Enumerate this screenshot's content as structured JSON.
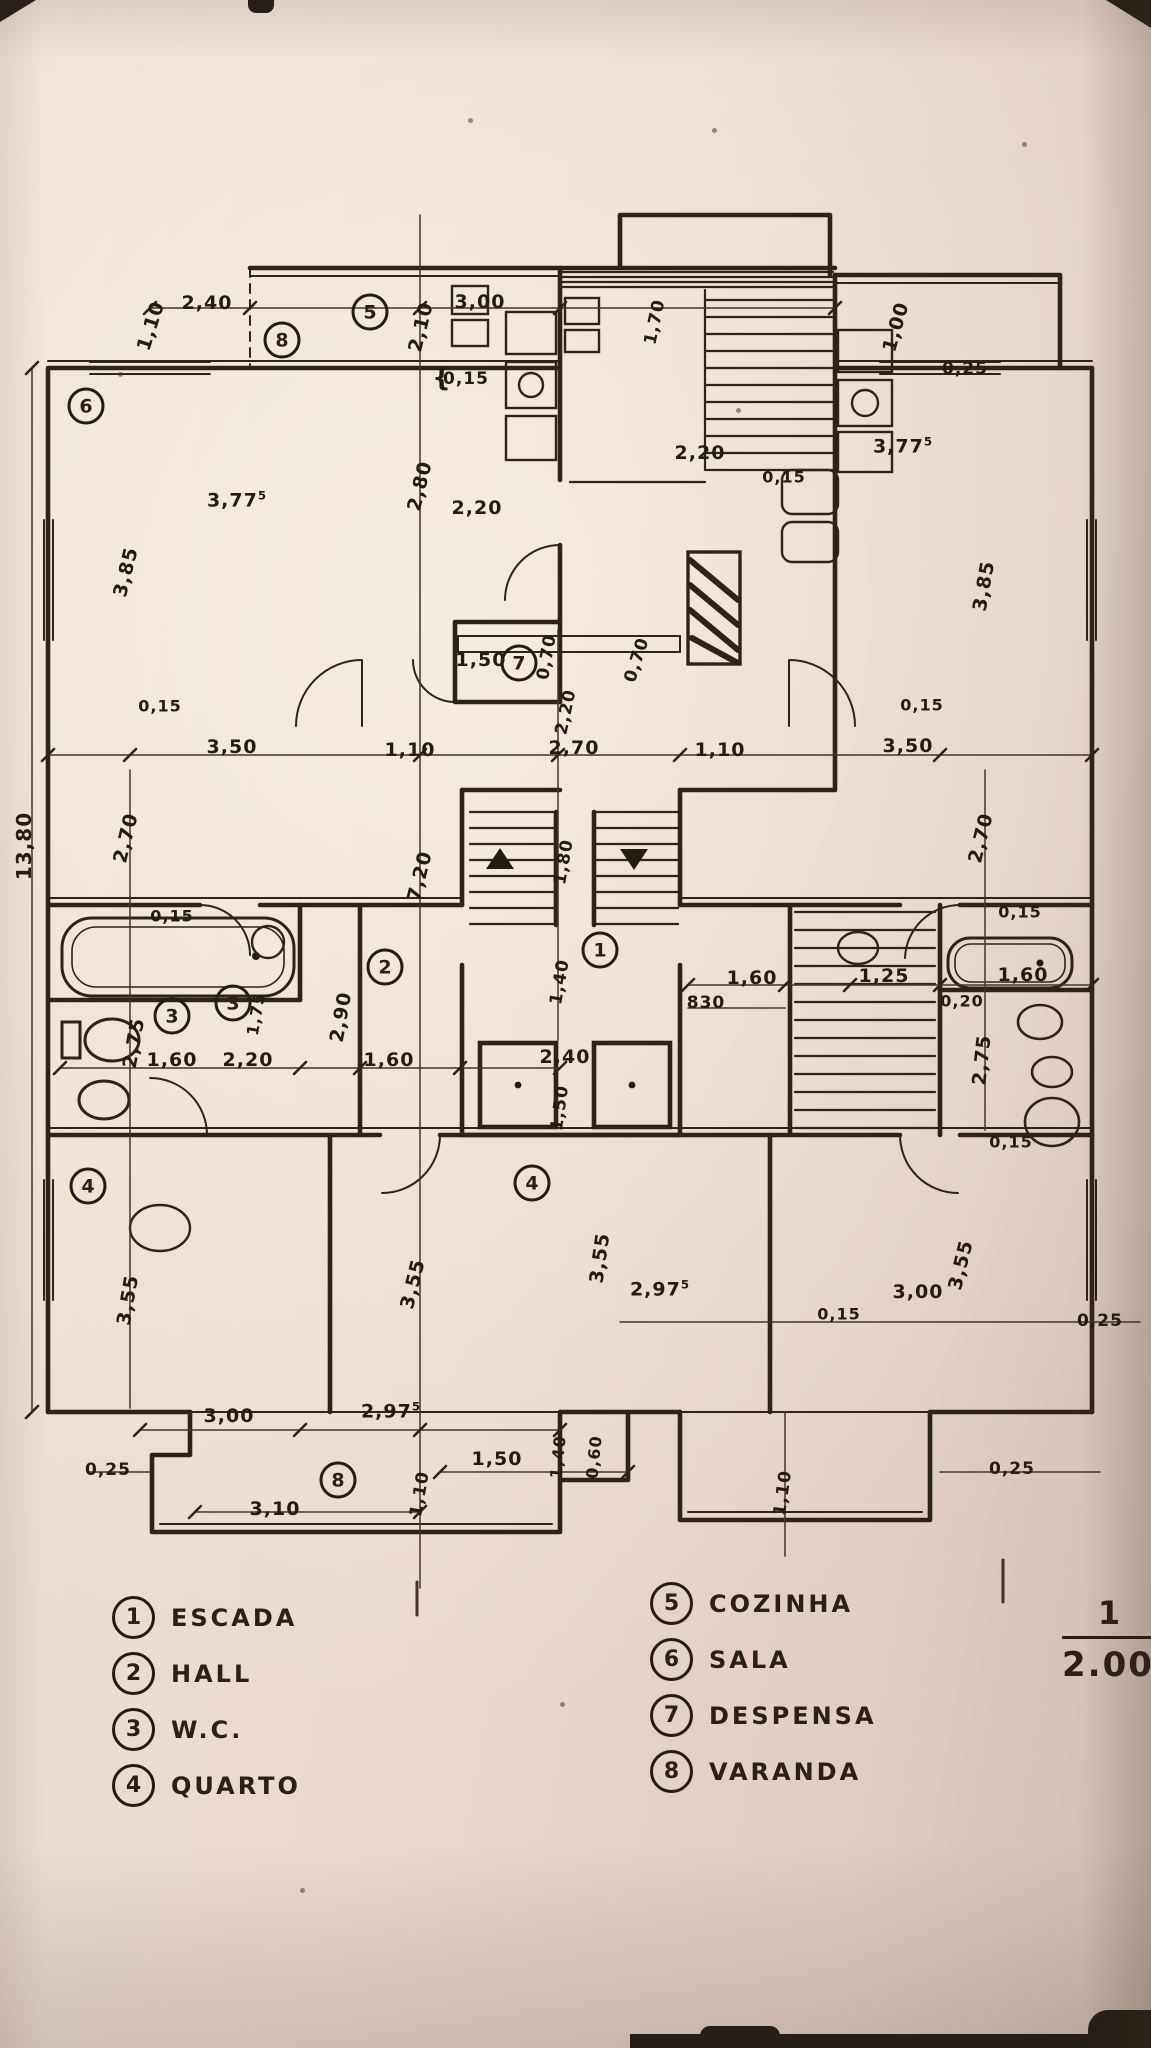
{
  "photo": {
    "paper_color": "#e8dacd",
    "ink_color": "#2a2018"
  },
  "legend_left": {
    "items": [
      {
        "num": "1",
        "label": "ESCADA"
      },
      {
        "num": "2",
        "label": "HALL"
      },
      {
        "num": "3",
        "label": "W.C."
      },
      {
        "num": "4",
        "label": "QUARTO"
      }
    ]
  },
  "legend_right": {
    "items": [
      {
        "num": "5",
        "label": "COZINHA"
      },
      {
        "num": "6",
        "label": "SALA"
      },
      {
        "num": "7",
        "label": "DESPENSA"
      },
      {
        "num": "8",
        "label": "VARANDA"
      }
    ]
  },
  "scale": {
    "numerator": "1",
    "denominator": "2.000"
  },
  "plan": {
    "room_markers": [
      {
        "num": "5",
        "x": 370,
        "y": 312
      },
      {
        "num": "8",
        "x": 282,
        "y": 340
      },
      {
        "num": "6",
        "x": 86,
        "y": 406
      },
      {
        "num": "7",
        "x": 519,
        "y": 663
      },
      {
        "num": "1",
        "x": 600,
        "y": 950
      },
      {
        "num": "2",
        "x": 385,
        "y": 967
      },
      {
        "num": "3",
        "x": 172,
        "y": 1016
      },
      {
        "num": "3",
        "x": 233,
        "y": 1003
      },
      {
        "num": "4",
        "x": 88,
        "y": 1186
      },
      {
        "num": "4",
        "x": 532,
        "y": 1183
      },
      {
        "num": "8",
        "x": 338,
        "y": 1480
      }
    ],
    "dimensions": [
      {
        "t": "1,10",
        "x": 151,
        "y": 326,
        "r": -72
      },
      {
        "t": "2,40",
        "x": 207,
        "y": 303
      },
      {
        "t": "3,00",
        "x": 480,
        "y": 302
      },
      {
        "t": "2,10",
        "x": 421,
        "y": 327,
        "r": -76
      },
      {
        "t": "1,70",
        "x": 655,
        "y": 322,
        "r": -78,
        "fs": 17
      },
      {
        "t": "1,00",
        "x": 896,
        "y": 327,
        "r": -74
      },
      {
        "t": "0,25",
        "x": 965,
        "y": 369,
        "fs": 17
      },
      {
        "t": "{",
        "x": 442,
        "y": 378,
        "fs": 26
      },
      {
        "t": "0,15",
        "x": 466,
        "y": 379,
        "fs": 17
      },
      {
        "t": "2,20",
        "x": 700,
        "y": 453
      },
      {
        "t": "3,77",
        "sup": "5",
        "x": 903,
        "y": 446
      },
      {
        "t": "0,15",
        "x": 784,
        "y": 477,
        "fs": 16
      },
      {
        "t": "3,77",
        "sup": "5",
        "x": 237,
        "y": 500
      },
      {
        "t": "2,80",
        "x": 420,
        "y": 486,
        "r": -76
      },
      {
        "t": "2,20",
        "x": 477,
        "y": 508
      },
      {
        "t": "3,85",
        "x": 126,
        "y": 572,
        "r": -76
      },
      {
        "t": "3,85",
        "x": 984,
        "y": 586,
        "r": -80
      },
      {
        "t": "1,50",
        "x": 481,
        "y": 660
      },
      {
        "t": "0,70",
        "x": 547,
        "y": 657,
        "r": -80,
        "fs": 17
      },
      {
        "t": "0,70",
        "x": 637,
        "y": 660,
        "r": -72,
        "fs": 17
      },
      {
        "t": "2,20",
        "x": 566,
        "y": 712,
        "r": -78,
        "fs": 17
      },
      {
        "t": "0,15",
        "x": 160,
        "y": 706,
        "fs": 16
      },
      {
        "t": "3,50",
        "x": 232,
        "y": 747
      },
      {
        "t": "1,10",
        "x": 410,
        "y": 750
      },
      {
        "t": "2,70",
        "x": 574,
        "y": 748
      },
      {
        "t": "1,10",
        "x": 720,
        "y": 750
      },
      {
        "t": "3,50",
        "x": 908,
        "y": 746
      },
      {
        "t": "0,15",
        "x": 922,
        "y": 705,
        "fs": 16
      },
      {
        "t": "13,80",
        "x": 24,
        "y": 846,
        "r": -90,
        "fs": 20
      },
      {
        "t": "2,70",
        "x": 126,
        "y": 838,
        "r": -76
      },
      {
        "t": "7,20",
        "x": 420,
        "y": 876,
        "r": -76
      },
      {
        "t": "1,80",
        "x": 564,
        "y": 862,
        "r": -80,
        "fs": 17
      },
      {
        "t": "2,70",
        "x": 981,
        "y": 838,
        "r": -76
      },
      {
        "t": "0,15",
        "x": 172,
        "y": 916,
        "fs": 16
      },
      {
        "t": "0,15",
        "x": 1020,
        "y": 912,
        "fs": 16
      },
      {
        "t": "1,40",
        "x": 560,
        "y": 982,
        "r": -80,
        "fs": 17
      },
      {
        "t": "1,60",
        "x": 752,
        "y": 978
      },
      {
        "t": "830",
        "x": 706,
        "y": 1003,
        "fs": 17
      },
      {
        "t": "1,25",
        "x": 884,
        "y": 976
      },
      {
        "t": "1,60",
        "x": 1023,
        "y": 975
      },
      {
        "t": "0,20",
        "x": 962,
        "y": 1001,
        "fs": 16
      },
      {
        "t": "2,75",
        "x": 982,
        "y": 1060,
        "r": -84
      },
      {
        "t": "2,75",
        "x": 134,
        "y": 1043,
        "r": -80
      },
      {
        "t": "1,60",
        "x": 172,
        "y": 1060
      },
      {
        "t": "1,75",
        "x": 256,
        "y": 1014,
        "r": -80,
        "fs": 16
      },
      {
        "t": "2,20",
        "x": 248,
        "y": 1060
      },
      {
        "t": "2,90",
        "x": 341,
        "y": 1017,
        "r": -80
      },
      {
        "t": "1,60",
        "x": 389,
        "y": 1060
      },
      {
        "t": "2,40",
        "x": 565,
        "y": 1057
      },
      {
        "t": "1,50",
        "x": 560,
        "y": 1108,
        "r": -82,
        "fs": 17
      },
      {
        "t": "0,15",
        "x": 1011,
        "y": 1142,
        "fs": 16
      },
      {
        "t": "3,55",
        "x": 128,
        "y": 1300,
        "r": -80
      },
      {
        "t": "3,55",
        "x": 413,
        "y": 1284,
        "r": -76
      },
      {
        "t": "3,55",
        "x": 600,
        "y": 1258,
        "r": -82
      },
      {
        "t": "3,55",
        "x": 961,
        "y": 1265,
        "r": -76
      },
      {
        "t": "2,97",
        "sup": "5",
        "x": 660,
        "y": 1289
      },
      {
        "t": "3,00",
        "x": 918,
        "y": 1292
      },
      {
        "t": "0,15",
        "x": 839,
        "y": 1314,
        "fs": 16
      },
      {
        "t": "0,25",
        "x": 1100,
        "y": 1321,
        "fs": 17
      },
      {
        "t": "3,00",
        "x": 229,
        "y": 1416
      },
      {
        "t": "2,97",
        "sup": "5",
        "x": 391,
        "y": 1411
      },
      {
        "t": "0,25",
        "x": 108,
        "y": 1470,
        "fs": 17
      },
      {
        "t": "3,10",
        "x": 275,
        "y": 1509
      },
      {
        "t": "1,10",
        "x": 420,
        "y": 1494,
        "r": -80,
        "fs": 17
      },
      {
        "t": "1,50",
        "x": 497,
        "y": 1459
      },
      {
        "t": "1,40",
        "x": 558,
        "y": 1457,
        "r": -84,
        "fs": 16
      },
      {
        "t": "0,60",
        "x": 594,
        "y": 1457,
        "r": -84,
        "fs": 16
      },
      {
        "t": "1,10",
        "x": 783,
        "y": 1493,
        "r": -82,
        "fs": 17
      },
      {
        "t": "0,25",
        "x": 1012,
        "y": 1469,
        "fs": 17
      }
    ]
  }
}
